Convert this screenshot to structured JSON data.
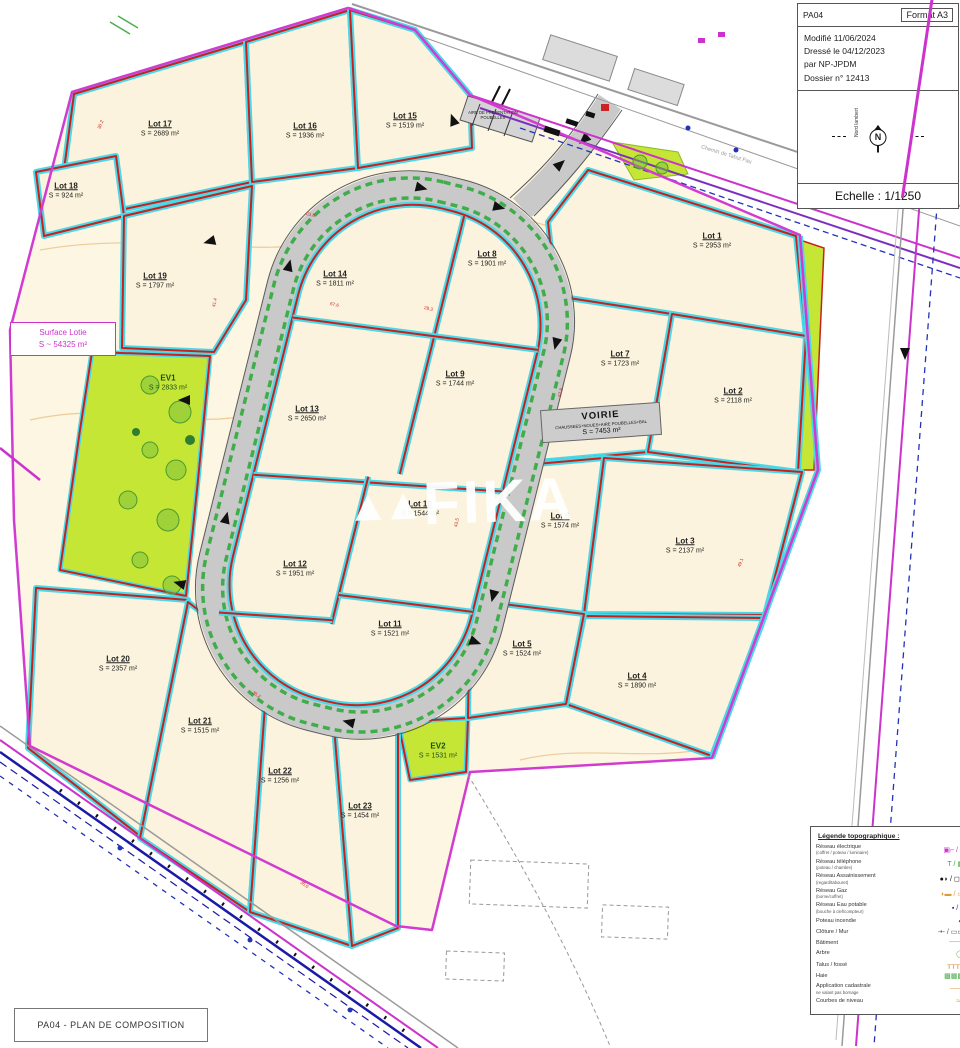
{
  "title_block": {
    "code": "PA04",
    "format": "Format A3",
    "modified": "Modifié 11/06/2024",
    "drawn": "Dressé le 04/12/2023",
    "author": "par NP-JPDM",
    "dossier": "Dossier n° 12413",
    "scale": "Echelle : 1/1250",
    "north_letter": "N",
    "north_caption": "Nord lambert"
  },
  "footer": {
    "title": "PA04 - PLAN DE COMPOSITION"
  },
  "watermark": {
    "logo": "▲▲",
    "text": "FIKA"
  },
  "surface_lotie": {
    "line1": "Surface Lotie",
    "line2": "S ~ 54325 m²"
  },
  "voirie": {
    "name": "VOIRIE",
    "detail": "CHAUSSEES+NOUES+AIRE POUBELLES+BAL",
    "area": "S = 7453 m²"
  },
  "poubelles": {
    "line1": "AIRE DE PRESENTATION",
    "line2": "POUBELLES"
  },
  "street_label": "Chemin de Tabut Fau",
  "lots": [
    {
      "id": "1",
      "name": "Lot 1",
      "area": "S = 2953 m²",
      "x": 712,
      "y": 240
    },
    {
      "id": "2",
      "name": "Lot 2",
      "area": "S = 2118 m²",
      "x": 733,
      "y": 395
    },
    {
      "id": "3",
      "name": "Lot 3",
      "area": "S = 2137 m²",
      "x": 685,
      "y": 545
    },
    {
      "id": "4",
      "name": "Lot 4",
      "area": "S = 1890 m²",
      "x": 637,
      "y": 680
    },
    {
      "id": "5",
      "name": "Lot 5",
      "area": "S = 1524 m²",
      "x": 522,
      "y": 648
    },
    {
      "id": "6",
      "name": "Lot 6",
      "area": "S = 1574 m²",
      "x": 560,
      "y": 520
    },
    {
      "id": "7",
      "name": "Lot 7",
      "area": "S = 1723 m²",
      "x": 620,
      "y": 358
    },
    {
      "id": "8",
      "name": "Lot 8",
      "area": "S = 1901 m²",
      "x": 487,
      "y": 258
    },
    {
      "id": "9",
      "name": "Lot 9",
      "area": "S = 1744 m²",
      "x": 455,
      "y": 378
    },
    {
      "id": "10",
      "name": "Lot 10",
      "area": "S = 1544 m²",
      "x": 420,
      "y": 508
    },
    {
      "id": "11",
      "name": "Lot 11",
      "area": "S = 1521 m²",
      "x": 390,
      "y": 628
    },
    {
      "id": "12",
      "name": "Lot 12",
      "area": "S = 1951 m²",
      "x": 295,
      "y": 568
    },
    {
      "id": "13",
      "name": "Lot 13",
      "area": "S = 2650 m²",
      "x": 307,
      "y": 413
    },
    {
      "id": "14",
      "name": "Lot 14",
      "area": "S = 1811 m²",
      "x": 335,
      "y": 278
    },
    {
      "id": "15",
      "name": "Lot 15",
      "area": "S = 1519 m²",
      "x": 405,
      "y": 120
    },
    {
      "id": "16",
      "name": "Lot 16",
      "area": "S = 1936 m²",
      "x": 305,
      "y": 130
    },
    {
      "id": "17",
      "name": "Lot 17",
      "area": "S = 2689 m²",
      "x": 160,
      "y": 128
    },
    {
      "id": "18",
      "name": "Lot 18",
      "area": "S = 924 m²",
      "x": 66,
      "y": 190
    },
    {
      "id": "19",
      "name": "Lot 19",
      "area": "S = 1797 m²",
      "x": 155,
      "y": 280
    },
    {
      "id": "20",
      "name": "Lot 20",
      "area": "S = 2357 m²",
      "x": 118,
      "y": 663
    },
    {
      "id": "21",
      "name": "Lot 21",
      "area": "S = 1515 m²",
      "x": 200,
      "y": 725
    },
    {
      "id": "22",
      "name": "Lot 22",
      "area": "S = 1256 m²",
      "x": 280,
      "y": 775
    },
    {
      "id": "23",
      "name": "Lot 23",
      "area": "S = 1454 m²",
      "x": 360,
      "y": 810
    }
  ],
  "green_spaces": [
    {
      "id": "ev1",
      "name": "EV1",
      "area": "S = 2833 m²",
      "x": 168,
      "y": 382
    },
    {
      "id": "ev2",
      "name": "EV2",
      "area": "S = 1531 m²",
      "x": 438,
      "y": 750
    }
  ],
  "dims": [
    {
      "t": "67.6",
      "x": 330,
      "y": 302,
      "r": 14
    },
    {
      "t": "28.3",
      "x": 424,
      "y": 306,
      "r": 14
    },
    {
      "t": "57.8",
      "x": 556,
      "y": 390,
      "r": -76
    },
    {
      "t": "30.2",
      "x": 96,
      "y": 122,
      "r": -68
    },
    {
      "t": "43.5",
      "x": 452,
      "y": 520,
      "r": -76
    },
    {
      "t": "41.4",
      "x": 210,
      "y": 300,
      "r": -78
    },
    {
      "t": "35.2",
      "x": 252,
      "y": 692,
      "r": 35
    },
    {
      "t": "23.8",
      "x": 306,
      "y": 212,
      "r": 14
    },
    {
      "t": "49.1",
      "x": 736,
      "y": 560,
      "r": -70
    },
    {
      "t": "35.0",
      "x": 300,
      "y": 882,
      "r": 35
    }
  ],
  "legend": {
    "title": "Légende topographique :",
    "items": [
      {
        "label": "Réseau électrique",
        "sub": "(coffret / poteau / luminaire)",
        "sym": "▣⌐ / ⌐",
        "color": "#cc33cc"
      },
      {
        "label": "Réseau téléphone",
        "sub": "(poteau / chambre)",
        "sym": "T / ▦",
        "color": "#3aa23a"
      },
      {
        "label": "Réseau Assainissement",
        "sub": "(regard/tabouret)",
        "sym": "●◗ / ◻◗",
        "color": "#111111"
      },
      {
        "label": "Réseau Gaz",
        "sub": "(borne/coffret)",
        "sym": "◗▬ / ▭",
        "color": "#e09a3c"
      },
      {
        "label": "Réseau Eau potable",
        "sub": "(bouche à clef/compteur)",
        "sym": "▪ / ▮",
        "color": "#1f2fb8"
      },
      {
        "label": "Poteau incendie",
        "sub": "",
        "sym": "◆",
        "color": "#1f2fb8"
      },
      {
        "label": "Clôture / Mur",
        "sub": "",
        "sym": "-•- / ▭▭",
        "color": "#555555"
      },
      {
        "label": "Bâtiment",
        "sub": "",
        "sym": "───",
        "color": "#999999"
      },
      {
        "label": "Arbre",
        "sub": "",
        "sym": "◯",
        "color": "#5cae3c"
      },
      {
        "label": "Talus / fossé",
        "sub": "",
        "sym": "┰┰┰┰",
        "color": "#e0b070"
      },
      {
        "label": "Haie",
        "sub": "",
        "sym": "▩▩▩",
        "color": "#4cae4c"
      },
      {
        "label": "Application cadastrale",
        "sub": "ne valant pas bornage",
        "sym": "——",
        "color": "#e09a3c"
      },
      {
        "label": "Courbes de niveau",
        "sub": "",
        "sym": "≈≈",
        "color": "#e09a3c"
      }
    ]
  }
}
